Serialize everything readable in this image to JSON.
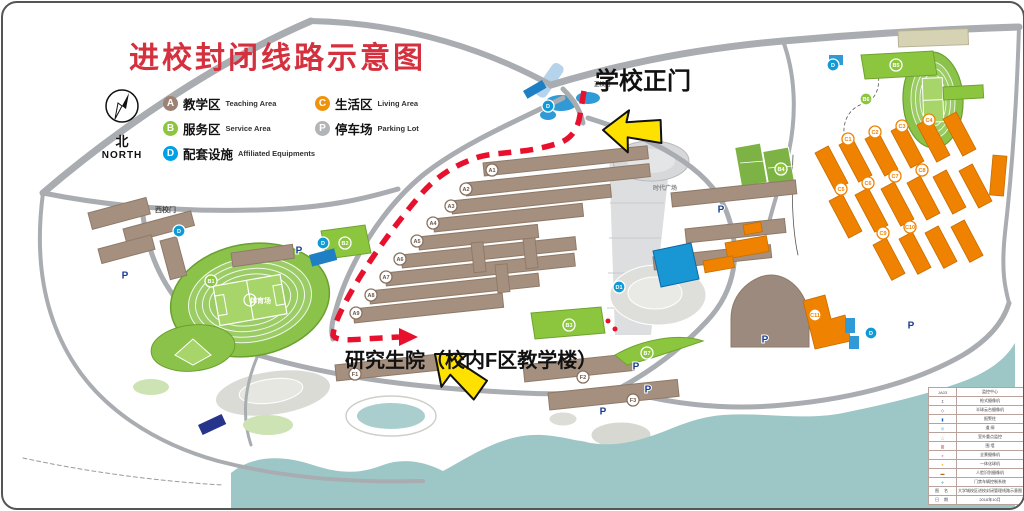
{
  "title": "进校封闭线路示意图",
  "compass": {
    "zh": "北",
    "en": "NORTH"
  },
  "legend": {
    "items": [
      {
        "id": "A",
        "zh": "教学区",
        "en": "Teaching Area",
        "color": "#9b8274"
      },
      {
        "id": "C",
        "zh": "生活区",
        "en": "Living Area",
        "color": "#f0930a"
      },
      {
        "id": "B",
        "zh": "服务区",
        "en": "Service Area",
        "color": "#8cc63f"
      },
      {
        "id": "P",
        "zh": "停车场",
        "en": "Parking Lot",
        "color": "#b2b5b8"
      },
      {
        "id": "D",
        "zh": "配套设施",
        "en": "Affiliated Equipments",
        "color": "#00a0e9"
      }
    ]
  },
  "annotations": {
    "main_gate": "学校正门",
    "grad_school": "研究生院（校内F区教学楼）"
  },
  "route": {
    "color": "#e8112d",
    "style": "dashed",
    "from": "学校正门",
    "to": "研究生院（校内F区教学楼）"
  },
  "map_labels": [
    {
      "text": "西校门",
      "x": 152,
      "y": 209,
      "size": 7,
      "color": "#4a4a4a"
    },
    {
      "text": "正校门",
      "x": 591,
      "y": 83,
      "size": 5.5,
      "color": "#4a4a4a"
    },
    {
      "text": "时代广场",
      "x": 650,
      "y": 187,
      "size": 6,
      "color": "#8a8a8a"
    },
    {
      "text": "体育场",
      "x": 247,
      "y": 300,
      "size": 7,
      "color": "#ffffff"
    }
  ],
  "marker_styles": {
    "A": {
      "bg": "#ffffff",
      "border": "#8a7261",
      "text": "#6b5849"
    },
    "F": {
      "bg": "#ffffff",
      "border": "#8a7261",
      "text": "#6b5849"
    },
    "B": {
      "bg": "#8cc63f",
      "border": "#ffffff",
      "text": "#ffffff"
    },
    "C": {
      "bg": "#ffffff",
      "border": "#ef8200",
      "text": "#ef8200"
    },
    "D": {
      "bg": "#0f9ad7",
      "border": "#ffffff",
      "text": "#ffffff"
    },
    "P": {
      "text": "#1a3f8f"
    }
  },
  "markers": {
    "A": [
      {
        "label": "A1",
        "x": 489,
        "y": 167
      },
      {
        "label": "A2",
        "x": 463,
        "y": 186
      },
      {
        "label": "A3",
        "x": 448,
        "y": 203
      },
      {
        "label": "A4",
        "x": 430,
        "y": 220
      },
      {
        "label": "A5",
        "x": 414,
        "y": 238
      },
      {
        "label": "A6",
        "x": 397,
        "y": 256
      },
      {
        "label": "A7",
        "x": 383,
        "y": 274
      },
      {
        "label": "A8",
        "x": 368,
        "y": 292
      },
      {
        "label": "A9",
        "x": 353,
        "y": 310
      }
    ],
    "F": [
      {
        "label": "F1",
        "x": 352,
        "y": 371
      },
      {
        "label": "F2",
        "x": 580,
        "y": 374
      },
      {
        "label": "F3",
        "x": 630,
        "y": 397
      }
    ],
    "B": [
      {
        "label": "B1",
        "x": 208,
        "y": 278
      },
      {
        "label": "B2",
        "x": 342,
        "y": 240
      },
      {
        "label": "B3",
        "x": 566,
        "y": 322
      },
      {
        "label": "B4",
        "x": 778,
        "y": 166
      },
      {
        "label": "B5",
        "x": 893,
        "y": 62
      },
      {
        "label": "B6",
        "x": 863,
        "y": 96
      },
      {
        "label": "B7",
        "x": 644,
        "y": 350
      }
    ],
    "C": [
      {
        "label": "C1",
        "x": 845,
        "y": 136
      },
      {
        "label": "C2",
        "x": 872,
        "y": 129
      },
      {
        "label": "C3",
        "x": 899,
        "y": 123
      },
      {
        "label": "C4",
        "x": 926,
        "y": 117
      },
      {
        "label": "C5",
        "x": 838,
        "y": 186
      },
      {
        "label": "C6",
        "x": 865,
        "y": 180
      },
      {
        "label": "C7",
        "x": 892,
        "y": 173
      },
      {
        "label": "C8",
        "x": 919,
        "y": 167
      },
      {
        "label": "C9",
        "x": 880,
        "y": 230
      },
      {
        "label": "C10",
        "x": 907,
        "y": 224
      },
      {
        "label": "C11",
        "x": 812,
        "y": 312
      }
    ],
    "D": [
      {
        "label": "D1",
        "x": 616,
        "y": 284
      },
      {
        "label": "D",
        "x": 176,
        "y": 228
      },
      {
        "label": "D",
        "x": 545,
        "y": 103
      },
      {
        "label": "D",
        "x": 868,
        "y": 330
      },
      {
        "label": "D",
        "x": 830,
        "y": 62
      },
      {
        "label": "D",
        "x": 320,
        "y": 240
      }
    ],
    "P": [
      {
        "label": "P",
        "x": 296,
        "y": 247
      },
      {
        "label": "P",
        "x": 122,
        "y": 272
      },
      {
        "label": "P",
        "x": 718,
        "y": 206
      },
      {
        "label": "P",
        "x": 762,
        "y": 336
      },
      {
        "label": "P",
        "x": 633,
        "y": 363
      },
      {
        "label": "P",
        "x": 645,
        "y": 386
      },
      {
        "label": "P",
        "x": 600,
        "y": 408
      },
      {
        "label": "P",
        "x": 908,
        "y": 322
      }
    ]
  },
  "info_table": {
    "rows": [
      {
        "sym": "JA03",
        "color": "#555555",
        "label": "监控中心"
      },
      {
        "sym": "↥",
        "color": "#555555",
        "label": "枪式摄像机"
      },
      {
        "sym": "◇",
        "color": "#555555",
        "label": "半球云台摄像机"
      },
      {
        "sym": "▮",
        "color": "#1565c0",
        "label": "报警柱"
      },
      {
        "sym": "◎",
        "color": "#29b6d8",
        "label": "道 闸"
      },
      {
        "sym": "△",
        "color": "#e8a13a",
        "label": "室外重点监控"
      },
      {
        "sym": "▥",
        "color": "#c0392b",
        "label": "围 墙"
      },
      {
        "sym": "●",
        "color": "#e591c8",
        "label": "全景摄像机"
      },
      {
        "sym": "●",
        "color": "#f0c040",
        "label": "一体化球机"
      },
      {
        "sym": "▬",
        "color": "#b5651d",
        "label": "人脸识别摄像机"
      },
      {
        "sym": "✚",
        "color": "#7fd4dc",
        "label": "门禁车辆控制系统"
      }
    ],
    "footer": [
      {
        "k": "图 名",
        "v": "大学城校区进校封闭管理线路示意图"
      },
      {
        "k": "日 期",
        "v": "2016年10月"
      }
    ]
  }
}
